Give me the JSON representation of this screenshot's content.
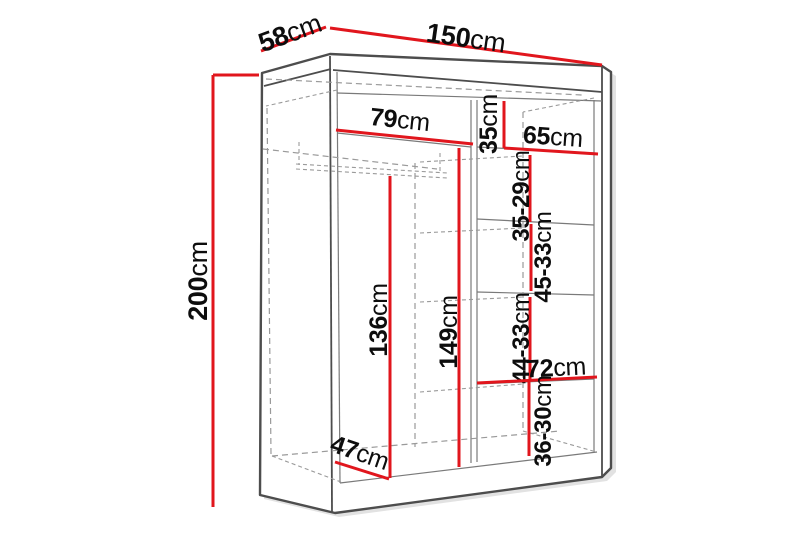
{
  "diagram": {
    "type": "wardrobe-dimension-diagram",
    "unit": "cm",
    "colors": {
      "dimension": "#e1161d",
      "outline": "#4d4d4d",
      "hidden": "#9a9a9a",
      "label": "#0d0d0d",
      "bg": "#ffffff"
    },
    "dimensions": {
      "width": {
        "value": "150",
        "unit": "cm"
      },
      "depth": {
        "value": "58",
        "unit": "cm"
      },
      "height": {
        "value": "200",
        "unit": "cm"
      },
      "left_section_width": {
        "value": "79",
        "unit": "cm"
      },
      "right_top_height": {
        "value": "35",
        "unit": "cm"
      },
      "right_section_width": {
        "value": "65",
        "unit": "cm"
      },
      "right_gap_1": {
        "value": "35-29",
        "unit": "cm"
      },
      "right_gap_2": {
        "value": "45-33",
        "unit": "cm"
      },
      "right_gap_3": {
        "value": "44-33",
        "unit": "cm"
      },
      "right_lower_width": {
        "value": "72",
        "unit": "cm"
      },
      "right_gap_4": {
        "value": "36-30",
        "unit": "cm"
      },
      "left_hanging_height": {
        "value": "136",
        "unit": "cm"
      },
      "middle_height": {
        "value": "149",
        "unit": "cm"
      },
      "interior_depth": {
        "value": "47",
        "unit": "cm"
      }
    }
  }
}
